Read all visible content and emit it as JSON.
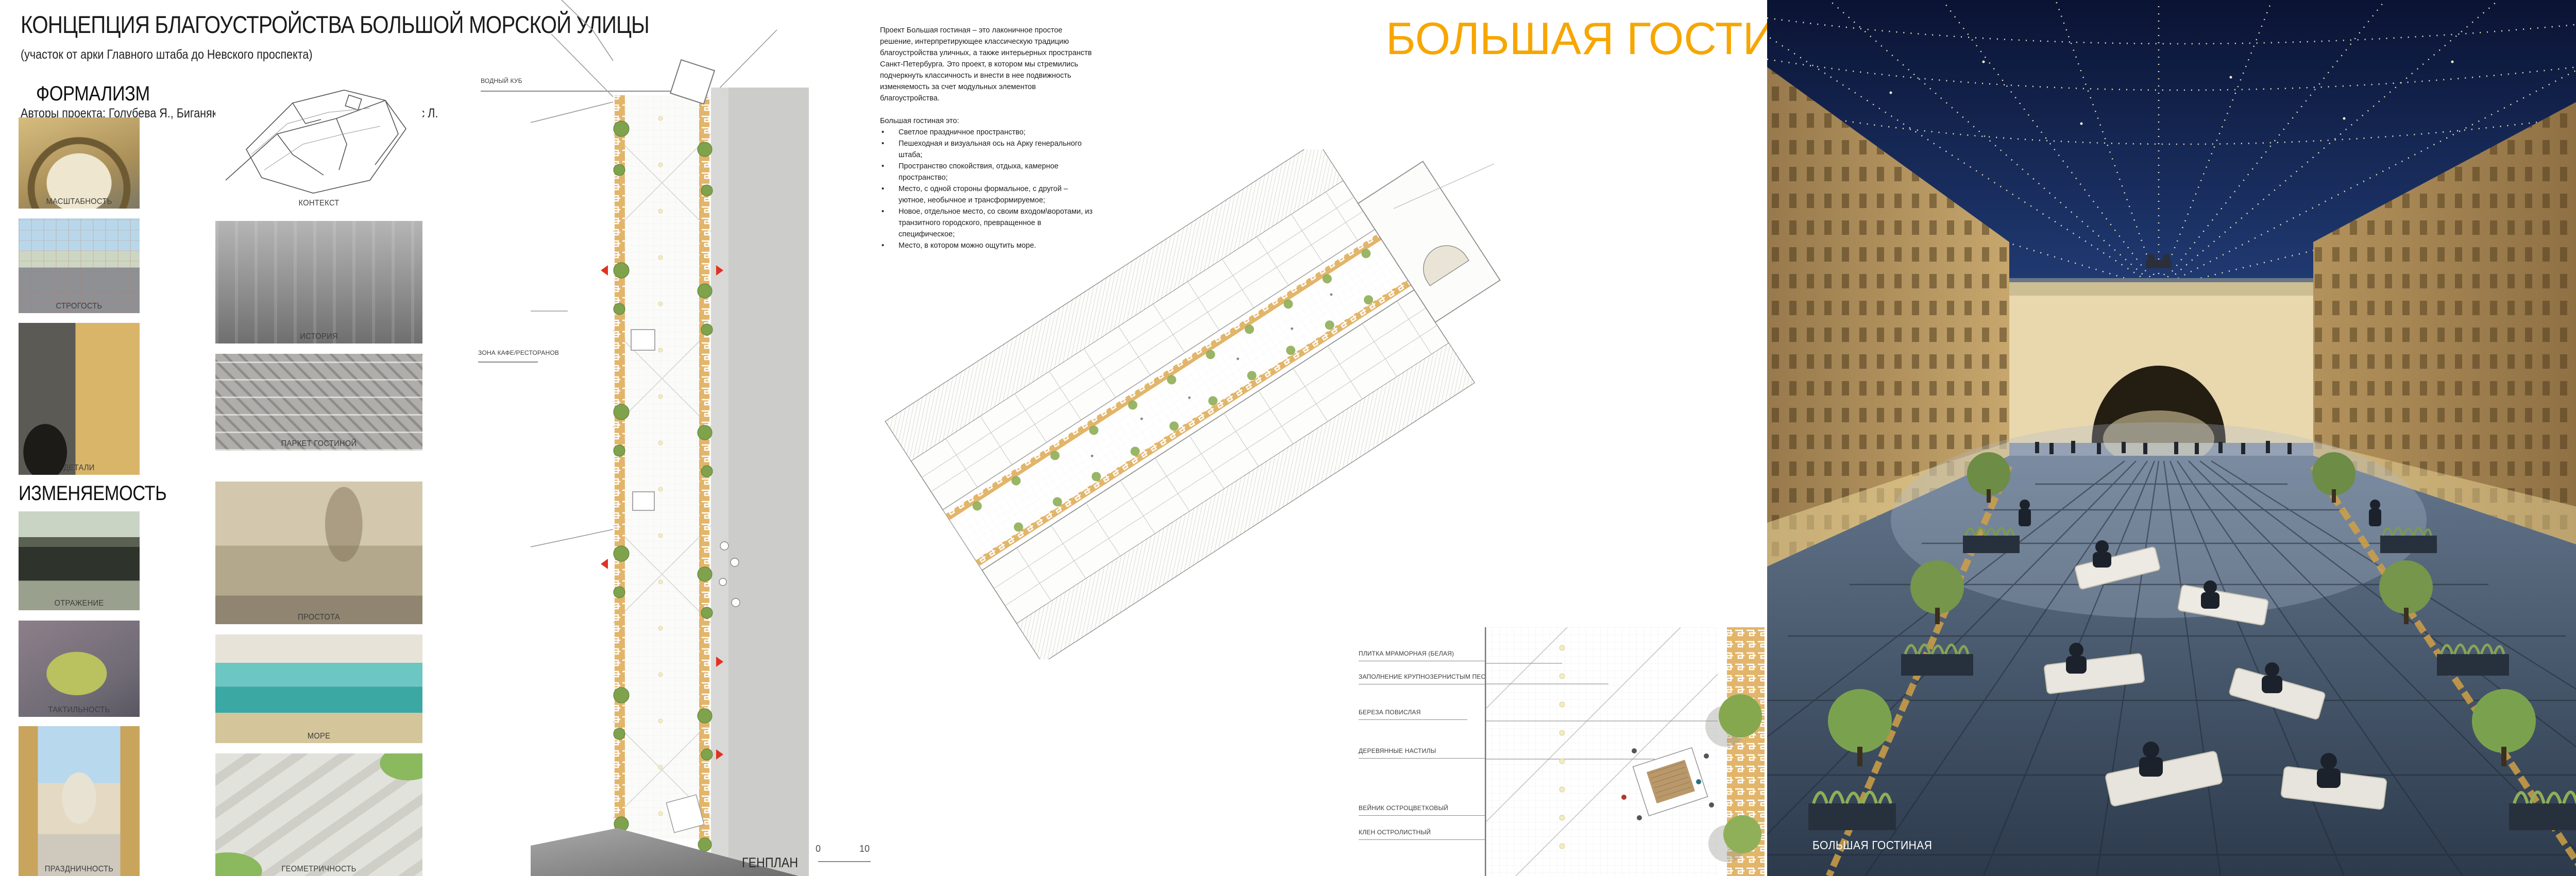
{
  "board": {
    "title": "КОНЦЕПЦИЯ БЛАГОУСТРОЙСТВА БОЛЬШОЙ МОРСКОЙ УЛИЦЫ",
    "subtitle": "(участок от арки Главного штаба до Невского проспекта)",
    "authors": "Авторы проекта: Голубева Я., Биганяков И., Халикова Т., Хитрина Н., Кьюйрос Л.",
    "accent_color": "#F7A600"
  },
  "left_panel": {
    "formalism": {
      "heading": "ФОРМАЛИЗМ",
      "items": [
        {
          "caption": "МАСШТАБНОСТЬ"
        },
        {
          "caption": "СТРОГОСТЬ"
        },
        {
          "caption": "ДЕТАЛИ"
        }
      ]
    },
    "changeability": {
      "heading": "ИЗМЕНЯЕМОСТЬ",
      "items": [
        {
          "caption": "ОТРАЖЕНИЕ"
        },
        {
          "caption": "ТАКТИЛЬНОСТЬ"
        },
        {
          "caption": "ПРАЗДНИЧНОСТЬ"
        }
      ]
    },
    "references": {
      "items": [
        {
          "caption": "КОНТЕКСТ"
        },
        {
          "caption": "ИСТОРИЯ"
        },
        {
          "caption": "ПАРКЕТ ГОСТИНОЙ"
        },
        {
          "caption": "ПРОСТОТА"
        },
        {
          "caption": "МОРЕ"
        },
        {
          "caption": "ГЕОМЕТРИЧНОСТЬ"
        }
      ]
    }
  },
  "masterplan": {
    "label": "ГЕНПЛАН",
    "callouts": [
      "ВОДНЫЙ КУБ",
      "ЗОНА КАФЕ/РЕСТОРАНОВ"
    ],
    "scale": {
      "start": "0",
      "end": "10"
    }
  },
  "description": {
    "paragraph": "Проект Большая гостиная – это лаконичное простое решение, интерпретирующее классическую традицию благоустройства уличных, а также интерьерных пространств Санкт-Петербурга. Это проект, в котором мы стремились подчеркнуть классичность и внести в нее подвижность изменяемость за счет модульных элементов благоустройства.",
    "list_intro": "Большая гостиная это:",
    "bullets": [
      "Светлое праздничное пространство;",
      "Пешеходная и визуальная ось на Арку генерального штаба;",
      "Пространство спокойствия, отдыха, камерное пространство;",
      "Место, с одной стороны формальное, с другой – уютное, необычное и трансформируемое;",
      "Новое, отдельное место, со своим входом\\воротами, из транзитного городского, превращенное в специфическое;",
      "Место, в котором можно ощутить море."
    ]
  },
  "project_title": "БОЛЬШАЯ ГОСТИНАЯ",
  "legend": {
    "items": [
      "ПЛИТКА МРАМОРНАЯ (БЕЛАЯ)",
      "ЗАПОЛНЕНИЕ КРУПНОЗЕРНИСТЫМ ПЕСКОМ",
      "БЕРЕЗА ПОВИСЛАЯ",
      "ДЕРЕВЯННЫЕ НАСТИЛЫ",
      "ВЕЙНИК ОСТРОЦВЕТКОВЫЙ",
      "КЛЕН ОСТРОЛИСТНЫЙ"
    ]
  },
  "renders": {
    "main": {
      "label": "БОЛЬШАЯ ГОСТИНАЯ"
    },
    "entrance": {
      "label": "ВХОДНАЯ ЗОНА"
    },
    "fragment": {
      "label": "ФРАГМЕНТ БЛАГОУСТРОЙСТВА"
    },
    "benches": {
      "label": "МОДУЛЬНЫЕ СКАМЕЙКИ"
    },
    "arch": {
      "label": "АРКА ГЕНШТАБА"
    }
  }
}
